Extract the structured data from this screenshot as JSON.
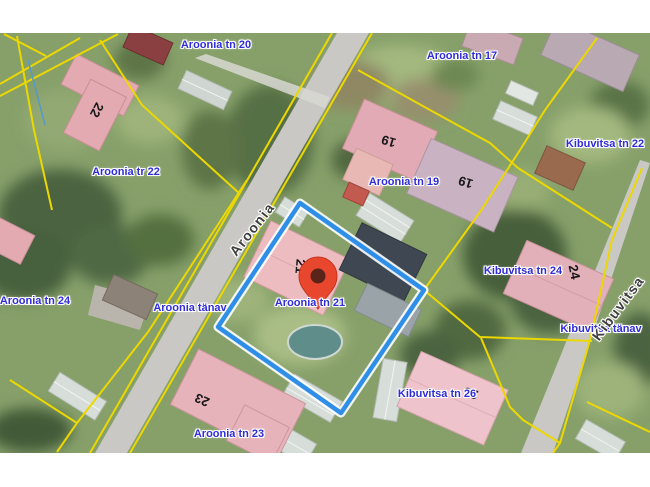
{
  "map": {
    "address_labels": [
      {
        "text": "Aroonia tn 20"
      },
      {
        "text": "Aroonia tn 17"
      },
      {
        "text": "Kibuvitsa tn 22"
      },
      {
        "text": "Aroonia tr 22"
      },
      {
        "text": "Aroonia tn 19"
      },
      {
        "text": "Aroonia tn 24"
      },
      {
        "text": "Aroonia tänav"
      },
      {
        "text": "Aroonia tn 21"
      },
      {
        "text": "Kibuvitsa tn 24"
      },
      {
        "text": "Kibuvitsa tänav"
      },
      {
        "text": "Kibuvitsa tn 26"
      },
      {
        "text": "Aroonia tn 23"
      }
    ],
    "street_labels": [
      {
        "text": "Aroonia"
      },
      {
        "text": "Kibuvitsa"
      }
    ],
    "building_numbers": [
      "22",
      "19",
      "19",
      "21",
      "24",
      "23",
      "26"
    ],
    "marker": {
      "address": "Aroonia tn 21"
    },
    "colors": {
      "cadastral_boundary": "#ecd800",
      "highlighted_parcel": "#2f8fe8",
      "highlight_casing": "#ffffff",
      "marker_red": "#e8472e",
      "marker_hole": "#5a241b",
      "address_label_blue": "#2f2cd8",
      "street_label_gray": "#3f3f3f",
      "building_pink": "#e7b6bd",
      "road_gray": "#c9c8c4",
      "ground_green": "#87a06a"
    }
  }
}
